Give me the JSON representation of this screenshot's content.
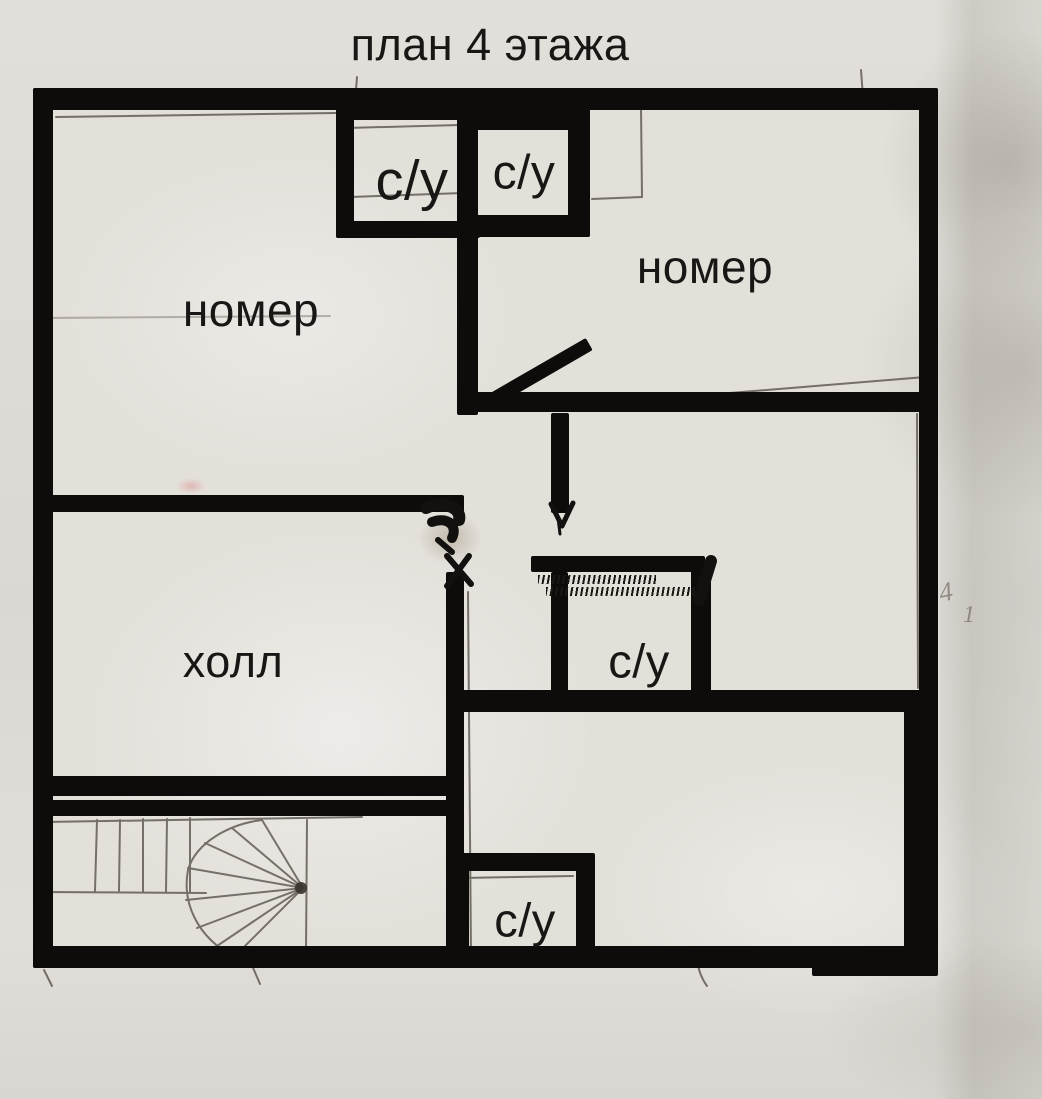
{
  "title": "план 4 этажа",
  "rooms": [
    {
      "name": "bath-top-left",
      "label": "с/у"
    },
    {
      "name": "bath-top-right",
      "label": "с/у"
    },
    {
      "name": "room-top-left",
      "label": "номер"
    },
    {
      "name": "room-top-right",
      "label": "номер"
    },
    {
      "name": "hall",
      "label": "холл"
    },
    {
      "name": "bath-middle",
      "label": "с/у"
    },
    {
      "name": "bath-bottom",
      "label": "с/у"
    }
  ],
  "pencil_marks": {
    "mark_4": "4",
    "mark_1": "1"
  },
  "colors": {
    "ink": "#0e0c0a",
    "paper": "#dfdcd7",
    "pencil": "#4a443c",
    "label": "#191715"
  }
}
